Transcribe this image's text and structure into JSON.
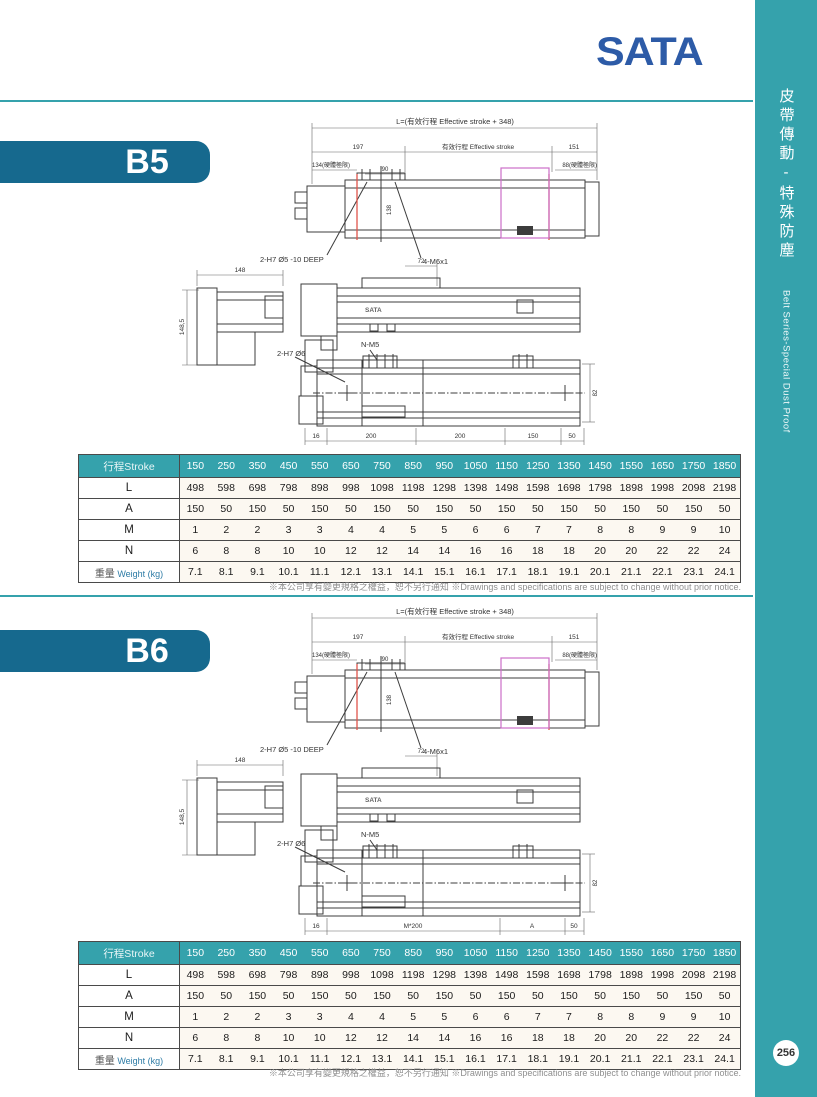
{
  "page": {
    "logo_text": "SATA",
    "note_text": "※本公司享有變更規格之權益，恕不另行通知 ※Drawings and specifications are subject to change without prior notice."
  },
  "sidebar": {
    "title_cn": "皮帶傳動-特殊防塵",
    "title_en": "Belt Series-Special Dust Proof",
    "page_number": "256"
  },
  "sections": [
    {
      "model": "B5",
      "drawing": {
        "dim_total": "L=(有效行程 Effective stroke + 348)",
        "dim_197": "197",
        "dim_effective": "有效行程 Effective stroke",
        "dim_151": "151",
        "dim_134": "134(硬體極限)",
        "dim_90": "90",
        "dim_88": "88(硬體極限)",
        "dim_138": "138",
        "label_holes_top": "2-H7 Ø5 -10 DEEP",
        "label_thread": "4-M6x1",
        "dim_72": "72",
        "dim_148": "148",
        "dim_148_5": "148,5",
        "label_nm5": "N-M5",
        "label_holes_bottom": "2-H7 Ø6",
        "dim_82": "82",
        "body_logo": "SATA",
        "bottom_dims": [
          "16",
          "200",
          "200",
          "150",
          "50"
        ]
      }
    },
    {
      "model": "B6",
      "drawing": {
        "dim_total": "L=(有效行程 Effective stroke + 348)",
        "dim_197": "197",
        "dim_effective": "有效行程 Effective stroke",
        "dim_151": "151",
        "dim_134": "134(硬體極限)",
        "dim_90": "90",
        "dim_88": "88(硬體極限)",
        "dim_138": "138",
        "label_holes_top": "2-H7 Ø5 -10 DEEP",
        "label_thread": "4-M6x1",
        "dim_72": "72",
        "dim_148": "148",
        "dim_148_5": "148,5",
        "label_nm5": "N-M5",
        "label_holes_bottom": "2-H7 Ø6",
        "dim_82": "82",
        "body_logo": "SATA",
        "bottom_dims": [
          "16",
          "M*200",
          "A",
          "50"
        ]
      }
    }
  ],
  "table": {
    "header_label": "行程Stroke",
    "strokes": [
      "150",
      "250",
      "350",
      "450",
      "550",
      "650",
      "750",
      "850",
      "950",
      "1050",
      "1150",
      "1250",
      "1350",
      "1450",
      "1550",
      "1650",
      "1750",
      "1850"
    ],
    "rows": [
      {
        "label": "L",
        "values": [
          "498",
          "598",
          "698",
          "798",
          "898",
          "998",
          "1098",
          "1198",
          "1298",
          "1398",
          "1498",
          "1598",
          "1698",
          "1798",
          "1898",
          "1998",
          "2098",
          "2198"
        ]
      },
      {
        "label": "A",
        "values": [
          "150",
          "50",
          "150",
          "50",
          "150",
          "50",
          "150",
          "50",
          "150",
          "50",
          "150",
          "50",
          "150",
          "50",
          "150",
          "50",
          "150",
          "50"
        ]
      },
      {
        "label": "M",
        "values": [
          "1",
          "2",
          "2",
          "3",
          "3",
          "4",
          "4",
          "5",
          "5",
          "6",
          "6",
          "7",
          "7",
          "8",
          "8",
          "9",
          "9",
          "10"
        ]
      },
      {
        "label": "N",
        "values": [
          "6",
          "8",
          "8",
          "10",
          "10",
          "12",
          "12",
          "14",
          "14",
          "16",
          "16",
          "18",
          "18",
          "20",
          "20",
          "22",
          "22",
          "24"
        ]
      }
    ],
    "weight_row": {
      "label_cn": "重量",
      "label_en": "Weight (kg)",
      "values": [
        "7.1",
        "8.1",
        "9.1",
        "10.1",
        "11.1",
        "12.1",
        "13.1",
        "14.1",
        "15.1",
        "16.1",
        "17.1",
        "18.1",
        "19.1",
        "20.1",
        "21.1",
        "22.1",
        "23.1",
        "24.1"
      ]
    }
  }
}
